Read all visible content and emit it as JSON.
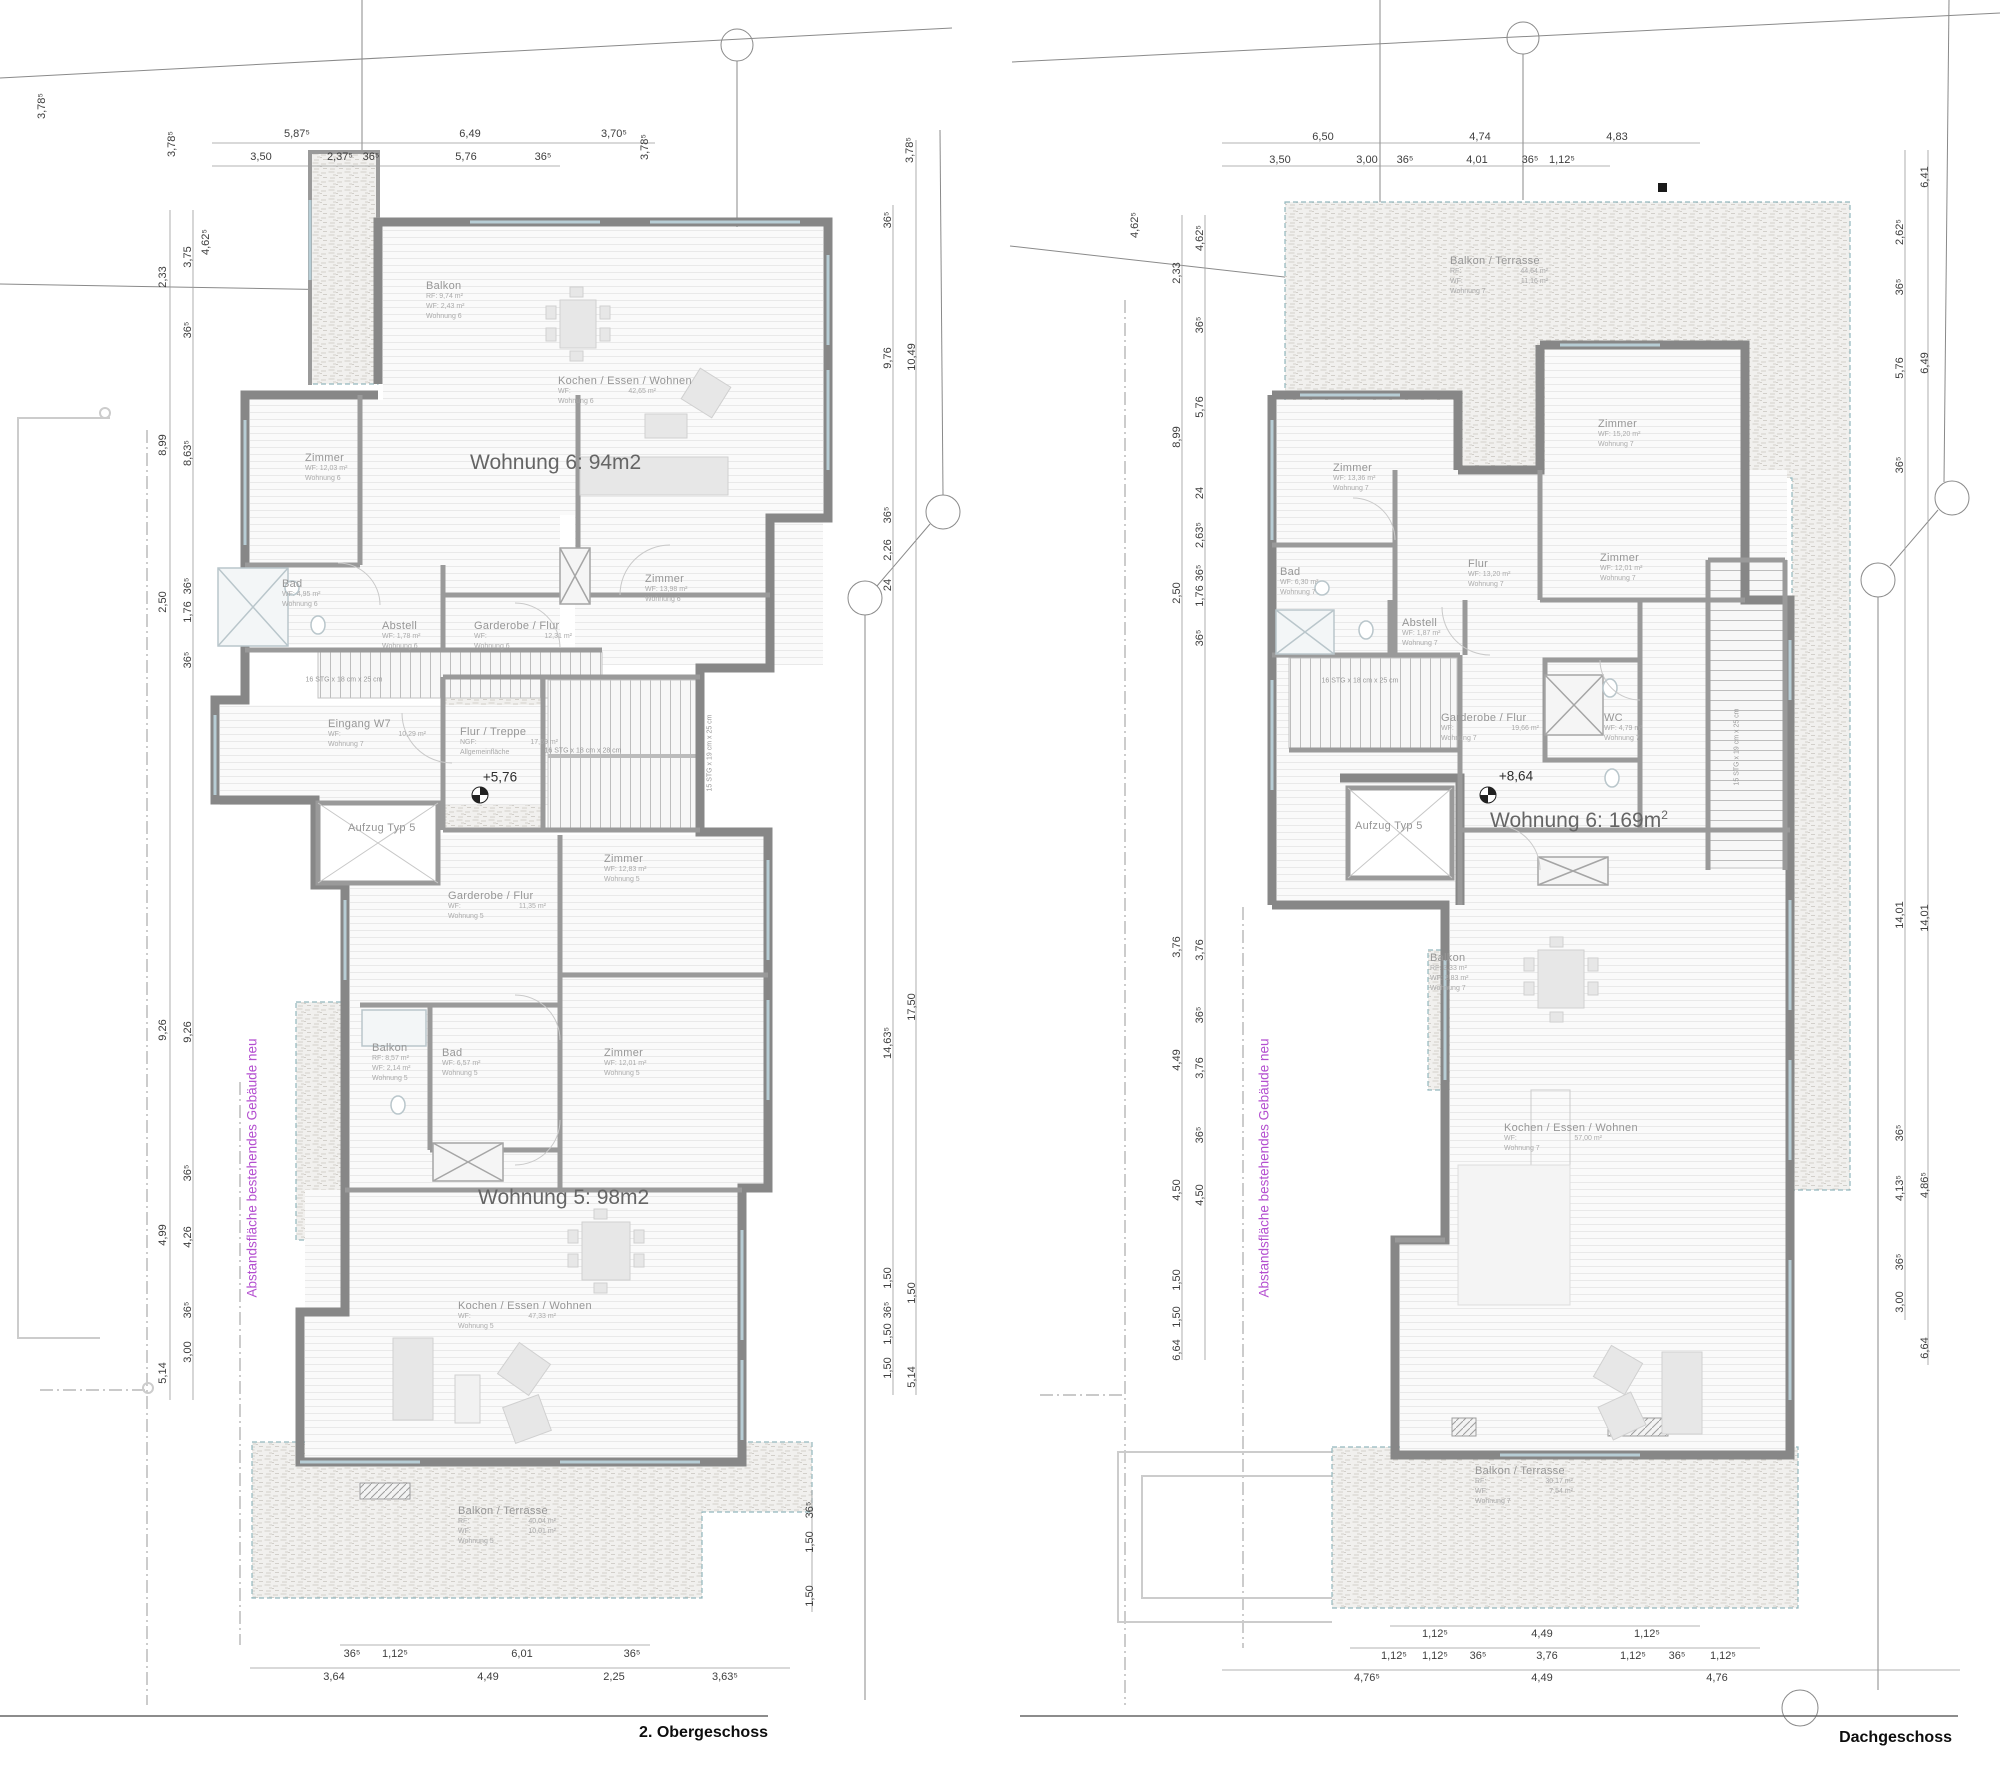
{
  "colors": {
    "boundary_note": "#b44fd0",
    "dimension_text": "#3d3d3d",
    "room_text": "#969696"
  },
  "left_plan": {
    "floor_label": "2. Obergeschoss",
    "boundary_note": {
      "text": "Abstandsfläche bestehendes Gebäude neu",
      "x": 252,
      "y": 1168
    },
    "big_labels": [
      {
        "text": "Wohnung 6: 94m2",
        "sup": "",
        "x": 470,
        "y": 450
      },
      {
        "text": "Wohnung 5: 98m2",
        "sup": "",
        "x": 478,
        "y": 1185
      }
    ],
    "rooms": [
      {
        "title": "Balkon",
        "x": 426,
        "y": 280,
        "lines": [
          "RF: 9,74 m²",
          "WF: 2,43 m²",
          "Wohnung 6"
        ]
      },
      {
        "title": "Kochen / Essen / Wohnen",
        "x": 558,
        "y": 375,
        "lines": [
          {
            "l": "WF:",
            "v": "42,65 m²"
          },
          "Wohnung 6"
        ]
      },
      {
        "title": "Zimmer",
        "x": 305,
        "y": 452,
        "lines": [
          "WF: 12,03 m²",
          "Wohnung 6"
        ]
      },
      {
        "title": "Bad",
        "x": 282,
        "y": 578,
        "lines": [
          "WF: 4,95 m²",
          "Wohnung 6"
        ]
      },
      {
        "title": "Abstell",
        "x": 382,
        "y": 620,
        "lines": [
          "WF: 1,78 m²",
          "Wohnung 6"
        ]
      },
      {
        "title": "Garderobe / Flur",
        "x": 474,
        "y": 620,
        "lines": [
          {
            "l": "WF:",
            "v": "12,31 m²"
          },
          "Wohnung 6"
        ]
      },
      {
        "title": "Zimmer",
        "x": 645,
        "y": 573,
        "lines": [
          "WF: 13,98 m²",
          "Wohnung 6"
        ]
      },
      {
        "title": "Eingang W7",
        "x": 328,
        "y": 718,
        "lines": [
          {
            "l": "WF:",
            "v": "10,29 m²"
          },
          "Wohnung 7"
        ]
      },
      {
        "title": "Flur / Treppe",
        "x": 460,
        "y": 726,
        "lines": [
          {
            "l": "NGF:",
            "v": "17,69 m²"
          },
          "Allgemeinfläche"
        ]
      },
      {
        "title": "Aufzug Typ 5",
        "x": 348,
        "y": 822,
        "lines": []
      },
      {
        "title": "Garderobe / Flur",
        "x": 448,
        "y": 890,
        "lines": [
          {
            "l": "WF:",
            "v": "11,35 m²"
          },
          "Wohnung 5"
        ]
      },
      {
        "title": "Zimmer",
        "x": 604,
        "y": 853,
        "lines": [
          "WF: 12,83 m²",
          "Wohnung 5"
        ]
      },
      {
        "title": "Balkon",
        "x": 372,
        "y": 1042,
        "lines": [
          "RF: 8,57 m²",
          "WF: 2,14 m²",
          "Wohnung 5"
        ]
      },
      {
        "title": "Bad",
        "x": 442,
        "y": 1047,
        "lines": [
          "WF: 6,57 m²",
          "Wohnung 5"
        ]
      },
      {
        "title": "Zimmer",
        "x": 604,
        "y": 1047,
        "lines": [
          "WF: 12,01 m²",
          "Wohnung 5"
        ]
      },
      {
        "title": "Kochen / Essen / Wohnen",
        "x": 458,
        "y": 1300,
        "lines": [
          {
            "l": "WF:",
            "v": "47,33 m²"
          },
          "Wohnung 5"
        ]
      },
      {
        "title": "Balkon / Terrasse",
        "x": 458,
        "y": 1505,
        "lines": [
          {
            "l": "RF:",
            "v": "40,04 m²"
          },
          {
            "l": "WF:",
            "v": "10,01 m²"
          },
          "Wohnung 5"
        ]
      }
    ],
    "notes": [
      {
        "t": "16 STG x 18 cm x 25 cm",
        "x": 344,
        "y": 680
      },
      {
        "t": "16 STG x 18 cm x 28 cm",
        "x": 583,
        "y": 751
      },
      {
        "t": "15 STG x 19 cm x 25 cm",
        "x": 710,
        "y": 753,
        "r": -90
      },
      {
        "t": "+5,76",
        "x": 500,
        "y": 777,
        "cls": "lvl"
      }
    ],
    "dims": [
      {
        "t": "5,87⁵",
        "x": 297,
        "y": 134
      },
      {
        "t": "6,49",
        "x": 470,
        "y": 134
      },
      {
        "t": "3,70⁵",
        "x": 614,
        "y": 134
      },
      {
        "t": "3,50",
        "x": 261,
        "y": 157
      },
      {
        "t": "2,37⁵",
        "x": 340,
        "y": 157
      },
      {
        "t": "36⁵",
        "x": 371,
        "y": 157
      },
      {
        "t": "5,76",
        "x": 466,
        "y": 157
      },
      {
        "t": "36⁵",
        "x": 543,
        "y": 157
      },
      {
        "t": "3,78⁵",
        "x": 42,
        "y": 106,
        "r": -90
      },
      {
        "t": "3,78⁵",
        "x": 172,
        "y": 144,
        "r": -90
      },
      {
        "t": "3,78⁵",
        "x": 645,
        "y": 147,
        "r": -90
      },
      {
        "t": "3,78⁵",
        "x": 910,
        "y": 150,
        "r": -90
      },
      {
        "t": "2,33",
        "x": 163,
        "y": 277,
        "r": -90
      },
      {
        "t": "8,99",
        "x": 163,
        "y": 445,
        "r": -90
      },
      {
        "t": "2,50",
        "x": 163,
        "y": 602,
        "r": -90
      },
      {
        "t": "9,26",
        "x": 163,
        "y": 1030,
        "r": -90
      },
      {
        "t": "4,99",
        "x": 163,
        "y": 1235,
        "r": -90
      },
      {
        "t": "5,14",
        "x": 163,
        "y": 1373,
        "r": -90
      },
      {
        "t": "3,75",
        "x": 188,
        "y": 257,
        "r": -90
      },
      {
        "t": "36⁵",
        "x": 188,
        "y": 330,
        "r": -90
      },
      {
        "t": "8,63⁵",
        "x": 188,
        "y": 453,
        "r": -90
      },
      {
        "t": "36⁵",
        "x": 188,
        "y": 586,
        "r": -90
      },
      {
        "t": "1,76",
        "x": 188,
        "y": 612,
        "r": -90
      },
      {
        "t": "36⁵",
        "x": 188,
        "y": 660,
        "r": -90
      },
      {
        "t": "9,26",
        "x": 188,
        "y": 1032,
        "r": -90
      },
      {
        "t": "36⁵",
        "x": 188,
        "y": 1173,
        "r": -90
      },
      {
        "t": "4,26",
        "x": 188,
        "y": 1237,
        "r": -90
      },
      {
        "t": "36⁵",
        "x": 188,
        "y": 1310,
        "r": -90
      },
      {
        "t": "3,00",
        "x": 188,
        "y": 1352,
        "r": -90
      },
      {
        "t": "4,62⁵",
        "x": 206,
        "y": 242,
        "r": -90
      },
      {
        "t": "36⁵",
        "x": 888,
        "y": 220,
        "r": -90
      },
      {
        "t": "9,76",
        "x": 888,
        "y": 358,
        "r": -90
      },
      {
        "t": "36⁵",
        "x": 888,
        "y": 515,
        "r": -90
      },
      {
        "t": "2,26",
        "x": 888,
        "y": 550,
        "r": -90
      },
      {
        "t": "24",
        "x": 888,
        "y": 585,
        "r": -90
      },
      {
        "t": "14,63⁵",
        "x": 888,
        "y": 1043,
        "r": -90
      },
      {
        "t": "1,50",
        "x": 888,
        "y": 1278,
        "r": -90
      },
      {
        "t": "36⁵",
        "x": 888,
        "y": 1310,
        "r": -90
      },
      {
        "t": "1,50",
        "x": 888,
        "y": 1334,
        "r": -90
      },
      {
        "t": "1,50",
        "x": 888,
        "y": 1368,
        "r": -90
      },
      {
        "t": "10,49",
        "x": 912,
        "y": 357,
        "r": -90
      },
      {
        "t": "17,50",
        "x": 912,
        "y": 1007,
        "r": -90
      },
      {
        "t": "1,50",
        "x": 912,
        "y": 1293,
        "r": -90
      },
      {
        "t": "5,14",
        "x": 912,
        "y": 1377,
        "r": -90
      },
      {
        "t": "36⁵",
        "x": 810,
        "y": 1510,
        "r": -90
      },
      {
        "t": "1,50",
        "x": 810,
        "y": 1542,
        "r": -90
      },
      {
        "t": "1,50",
        "x": 810,
        "y": 1596,
        "r": -90
      },
      {
        "t": "36⁵",
        "x": 352,
        "y": 1654
      },
      {
        "t": "1,12⁵",
        "x": 395,
        "y": 1654
      },
      {
        "t": "6,01",
        "x": 522,
        "y": 1654
      },
      {
        "t": "36⁵",
        "x": 632,
        "y": 1654
      },
      {
        "t": "3,64",
        "x": 334,
        "y": 1677
      },
      {
        "t": "4,49",
        "x": 488,
        "y": 1677
      },
      {
        "t": "2,25",
        "x": 614,
        "y": 1677
      },
      {
        "t": "3,63⁵",
        "x": 725,
        "y": 1677
      }
    ]
  },
  "right_plan": {
    "floor_label": "Dachgeschoss",
    "boundary_note": {
      "text": "Abstandsfläche bestehendes Gebäude neu",
      "x": 1264,
      "y": 1168
    },
    "big_labels": [
      {
        "text": "Wohnung 6: 169m",
        "sup": "2",
        "x": 1490,
        "y": 808
      }
    ],
    "rooms": [
      {
        "title": "Balkon / Terrasse",
        "x": 1450,
        "y": 255,
        "lines": [
          {
            "l": "RF:",
            "v": "44,64 m²"
          },
          {
            "l": "WF:",
            "v": "11,16 m²"
          },
          "Wohnung 7"
        ]
      },
      {
        "title": "Zimmer",
        "x": 1598,
        "y": 418,
        "lines": [
          "WF: 15,20 m²",
          "Wohnung 7"
        ]
      },
      {
        "title": "Zimmer",
        "x": 1333,
        "y": 462,
        "lines": [
          "WF: 13,36 m²",
          "Wohnung 7"
        ]
      },
      {
        "title": "Bad",
        "x": 1280,
        "y": 566,
        "lines": [
          "WF: 6,30 m²",
          "Wohnung 7"
        ]
      },
      {
        "title": "Flur",
        "x": 1468,
        "y": 558,
        "lines": [
          "WF: 13,20 m²",
          "Wohnung 7"
        ]
      },
      {
        "title": "Zimmer",
        "x": 1600,
        "y": 552,
        "lines": [
          "WF: 12,01 m²",
          "Wohnung 7"
        ]
      },
      {
        "title": "Abstell",
        "x": 1402,
        "y": 617,
        "lines": [
          "WF: 1,87 m²",
          "Wohnung 7"
        ]
      },
      {
        "title": "Garderobe / Flur",
        "x": 1441,
        "y": 712,
        "lines": [
          {
            "l": "WF:",
            "v": "19,66 m²"
          },
          "Wohnung 7"
        ]
      },
      {
        "title": "WC",
        "x": 1604,
        "y": 712,
        "lines": [
          "WF: 4,79 m²",
          "Wohnung 7"
        ]
      },
      {
        "title": "Aufzug Typ 5",
        "x": 1355,
        "y": 820,
        "lines": []
      },
      {
        "title": "Balkon",
        "x": 1430,
        "y": 952,
        "lines": [
          "RF: 3,33 m²",
          "WF: 2,83 m²",
          "Wohnung 7"
        ]
      },
      {
        "title": "Kochen / Essen / Wohnen",
        "x": 1504,
        "y": 1122,
        "lines": [
          {
            "l": "WF:",
            "v": "57,00 m²"
          },
          "Wohnung 7"
        ]
      },
      {
        "title": "Balkon / Terrasse",
        "x": 1475,
        "y": 1465,
        "lines": [
          {
            "l": "RF:",
            "v": "30,17 m²"
          },
          {
            "l": "WF:",
            "v": "7,54 m²"
          },
          "Wohnung 7"
        ]
      }
    ],
    "notes": [
      {
        "t": "16 STG x 18 cm x 25 cm",
        "x": 1360,
        "y": 681
      },
      {
        "t": "15 STG x 19 cm x 25 cm",
        "x": 1737,
        "y": 747,
        "r": -90
      },
      {
        "t": "+8,64",
        "x": 1516,
        "y": 776,
        "cls": "lvl"
      }
    ],
    "dims": [
      {
        "t": "6,50",
        "x": 1323,
        "y": 137
      },
      {
        "t": "4,74",
        "x": 1480,
        "y": 137
      },
      {
        "t": "4,83",
        "x": 1617,
        "y": 137
      },
      {
        "t": "3,50",
        "x": 1280,
        "y": 160
      },
      {
        "t": "3,00",
        "x": 1367,
        "y": 160
      },
      {
        "t": "36⁵",
        "x": 1405,
        "y": 160
      },
      {
        "t": "4,01",
        "x": 1477,
        "y": 160
      },
      {
        "t": "36⁵",
        "x": 1530,
        "y": 160
      },
      {
        "t": "1,12⁵",
        "x": 1562,
        "y": 160
      },
      {
        "t": "4,62⁵",
        "x": 1135,
        "y": 225,
        "r": -90
      },
      {
        "t": "2,33",
        "x": 1177,
        "y": 273,
        "r": -90
      },
      {
        "t": "8,99",
        "x": 1177,
        "y": 437,
        "r": -90
      },
      {
        "t": "2,50",
        "x": 1177,
        "y": 593,
        "r": -90
      },
      {
        "t": "3,76",
        "x": 1177,
        "y": 947,
        "r": -90
      },
      {
        "t": "4,49",
        "x": 1177,
        "y": 1060,
        "r": -90
      },
      {
        "t": "4,50",
        "x": 1177,
        "y": 1190,
        "r": -90
      },
      {
        "t": "1,50",
        "x": 1177,
        "y": 1280,
        "r": -90
      },
      {
        "t": "1,50",
        "x": 1177,
        "y": 1317,
        "r": -90
      },
      {
        "t": "6,64",
        "x": 1177,
        "y": 1350,
        "r": -90
      },
      {
        "t": "4,62⁵",
        "x": 1200,
        "y": 238,
        "r": -90
      },
      {
        "t": "36⁵",
        "x": 1200,
        "y": 325,
        "r": -90
      },
      {
        "t": "5,76",
        "x": 1200,
        "y": 407,
        "r": -90
      },
      {
        "t": "24",
        "x": 1200,
        "y": 493,
        "r": -90
      },
      {
        "t": "2,63⁵",
        "x": 1200,
        "y": 535,
        "r": -90
      },
      {
        "t": "36⁵",
        "x": 1200,
        "y": 573,
        "r": -90
      },
      {
        "t": "1,76",
        "x": 1200,
        "y": 596,
        "r": -90
      },
      {
        "t": "36⁵",
        "x": 1200,
        "y": 638,
        "r": -90
      },
      {
        "t": "3,76",
        "x": 1200,
        "y": 950,
        "r": -90
      },
      {
        "t": "36⁵",
        "x": 1200,
        "y": 1015,
        "r": -90
      },
      {
        "t": "3,76",
        "x": 1200,
        "y": 1068,
        "r": -90
      },
      {
        "t": "36⁵",
        "x": 1200,
        "y": 1135,
        "r": -90
      },
      {
        "t": "4,50",
        "x": 1200,
        "y": 1195,
        "r": -90
      },
      {
        "t": "2,62⁵",
        "x": 1900,
        "y": 232,
        "r": -90
      },
      {
        "t": "36⁵",
        "x": 1900,
        "y": 287,
        "r": -90
      },
      {
        "t": "5,76",
        "x": 1900,
        "y": 368,
        "r": -90
      },
      {
        "t": "36⁵",
        "x": 1900,
        "y": 465,
        "r": -90
      },
      {
        "t": "14,01",
        "x": 1900,
        "y": 915,
        "r": -90
      },
      {
        "t": "36⁵",
        "x": 1900,
        "y": 1133,
        "r": -90
      },
      {
        "t": "4,13⁵",
        "x": 1900,
        "y": 1188,
        "r": -90
      },
      {
        "t": "36⁵",
        "x": 1900,
        "y": 1262,
        "r": -90
      },
      {
        "t": "3,00",
        "x": 1900,
        "y": 1302,
        "r": -90
      },
      {
        "t": "6,41",
        "x": 1925,
        "y": 177,
        "r": -90
      },
      {
        "t": "6,49",
        "x": 1925,
        "y": 363,
        "r": -90
      },
      {
        "t": "14,01",
        "x": 1925,
        "y": 918,
        "r": -90
      },
      {
        "t": "4,86⁵",
        "x": 1925,
        "y": 1185,
        "r": -90
      },
      {
        "t": "6,64",
        "x": 1925,
        "y": 1348,
        "r": -90
      },
      {
        "t": "1,12⁵",
        "x": 1435,
        "y": 1634
      },
      {
        "t": "4,49",
        "x": 1542,
        "y": 1634
      },
      {
        "t": "1,12⁵",
        "x": 1647,
        "y": 1634
      },
      {
        "t": "1,12⁵",
        "x": 1394,
        "y": 1656
      },
      {
        "t": "1,12⁵",
        "x": 1435,
        "y": 1656
      },
      {
        "t": "36⁵",
        "x": 1478,
        "y": 1656
      },
      {
        "t": "3,76",
        "x": 1547,
        "y": 1656
      },
      {
        "t": "1,12⁵",
        "x": 1633,
        "y": 1656
      },
      {
        "t": "36⁵",
        "x": 1677,
        "y": 1656
      },
      {
        "t": "1,12⁵",
        "x": 1723,
        "y": 1656
      },
      {
        "t": "4,76⁵",
        "x": 1367,
        "y": 1678
      },
      {
        "t": "4,49",
        "x": 1542,
        "y": 1678
      },
      {
        "t": "4,76",
        "x": 1717,
        "y": 1678
      }
    ]
  }
}
